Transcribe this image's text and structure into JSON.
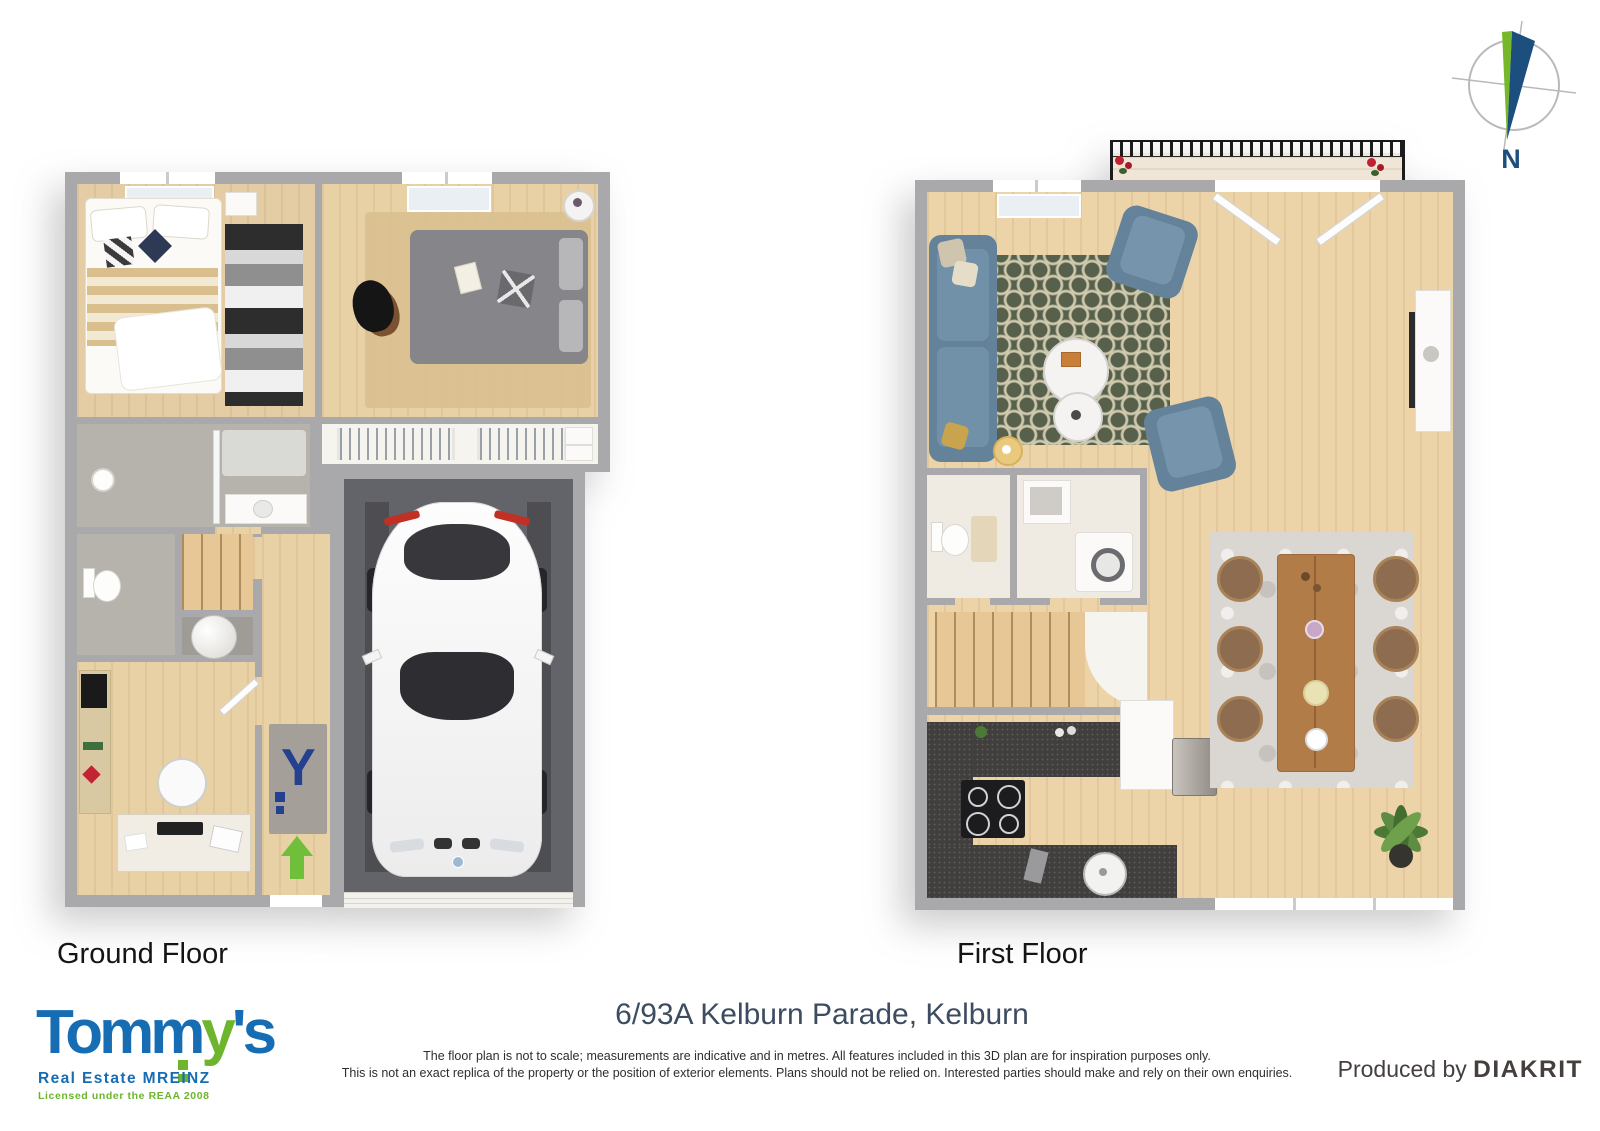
{
  "compass": {
    "label": "N"
  },
  "floors": {
    "ground_label": "Ground Floor",
    "first_label": "First Floor"
  },
  "address": "6/93A Kelburn Parade, Kelburn",
  "disclaimer": {
    "line1": "The floor plan is not to scale; measurements are indicative and in metres. All features included in this 3D plan are for inspiration purposes only.",
    "line2": "This is not an exact replica of the property or the position of exterior elements. Plans should not be relied on. Interested parties should make and rely on their own enquiries."
  },
  "branding": {
    "tommys_part1": "Tomm",
    "tommys_part2": "y",
    "tommys_part3": "'s",
    "tagline": "Real Estate MREINZ",
    "license": "Licensed under the REAA 2008",
    "produced_prefix": "Produced by ",
    "produced_name": "DIAKRIT"
  },
  "entry_mat_letter": "Y",
  "colors": {
    "brand_blue": "#176db4",
    "brand_green": "#6cb52d",
    "wall": "#a9a9ab",
    "wood_floor": "#e9d1a6",
    "garage_floor": "#63636a",
    "bathroom_floor": "#b6b2ac",
    "sofa_blue": "#64839b",
    "living_rug_olive": "#57604a",
    "dining_table_wood": "#b27c49",
    "kitchen_counter": "#403f3d",
    "entry_arrow_green": "#6fbf3a",
    "compass_needle_green": "#76b82a",
    "compass_needle_blue": "#1d4f7e",
    "address_text": "#3e4c61",
    "railing_black": "#1c1c1c",
    "mat_letter_blue": "#24408f"
  }
}
